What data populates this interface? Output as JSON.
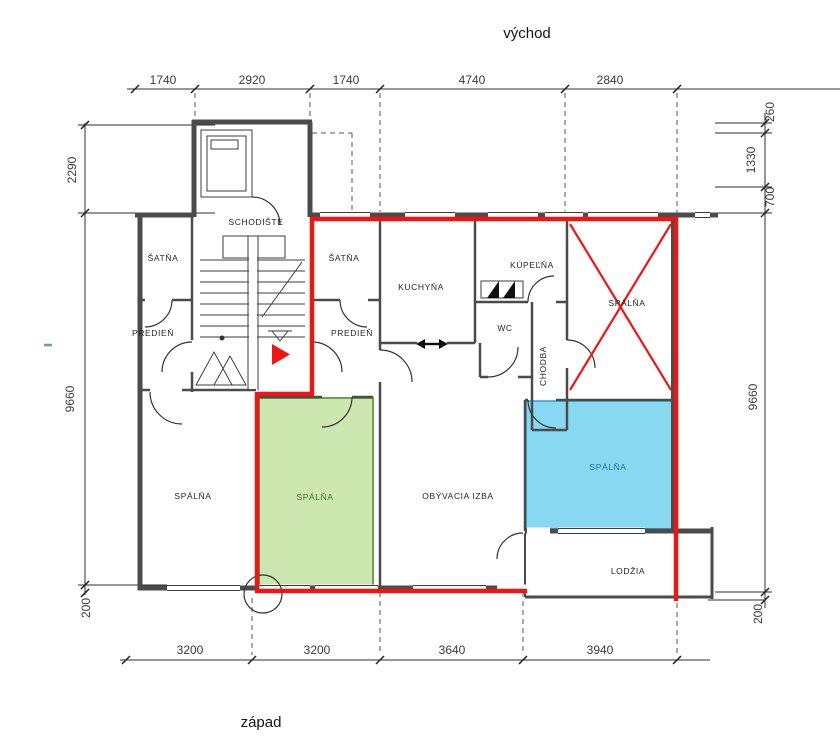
{
  "compass": {
    "top": "východ",
    "bottom": "západ"
  },
  "dims_top": [
    "1740",
    "2920",
    "1740",
    "4740",
    "2840"
  ],
  "dims_bottom": [
    "3200",
    "3200",
    "3640",
    "3940"
  ],
  "dims_left": [
    "2290",
    "9660",
    "200"
  ],
  "dims_right": [
    "260",
    "1330",
    "700",
    "9660",
    "200"
  ],
  "rooms": {
    "schodiste": "SCHODIŠTE",
    "satna_left": "ŠATŇA",
    "satna_right": "ŠATŇA",
    "predien_left": "PREDIEŇ",
    "predien_right": "PREDIEŇ",
    "kuchyna": "KUCHYŇA",
    "kupelna": "KÚPEĽŇA",
    "wc": "WC",
    "chodba": "CHODBA",
    "spalna_left": "SPÁLŇA",
    "spalna_green": "SPÁLŇA",
    "spalna_crossed": "SPÁLŇA",
    "spalna_blue": "SPÁLŇA",
    "obyvacia_izba": "OBÝVACIA IZBA",
    "lodzia": "LODŽIA"
  },
  "colors": {
    "highlight_green_fill": "#cde7b0",
    "highlight_green_border": "#6fa04b",
    "highlight_green_text": "#3f7528",
    "highlight_blue_fill": "#89d8f2",
    "highlight_blue_border": "#35a5d8",
    "highlight_blue_text": "#1c6fa3",
    "annotation_red": "#ee1515",
    "wall_gray": "#4b4b4b",
    "marker_blue_dash": "#5b9bd5"
  }
}
